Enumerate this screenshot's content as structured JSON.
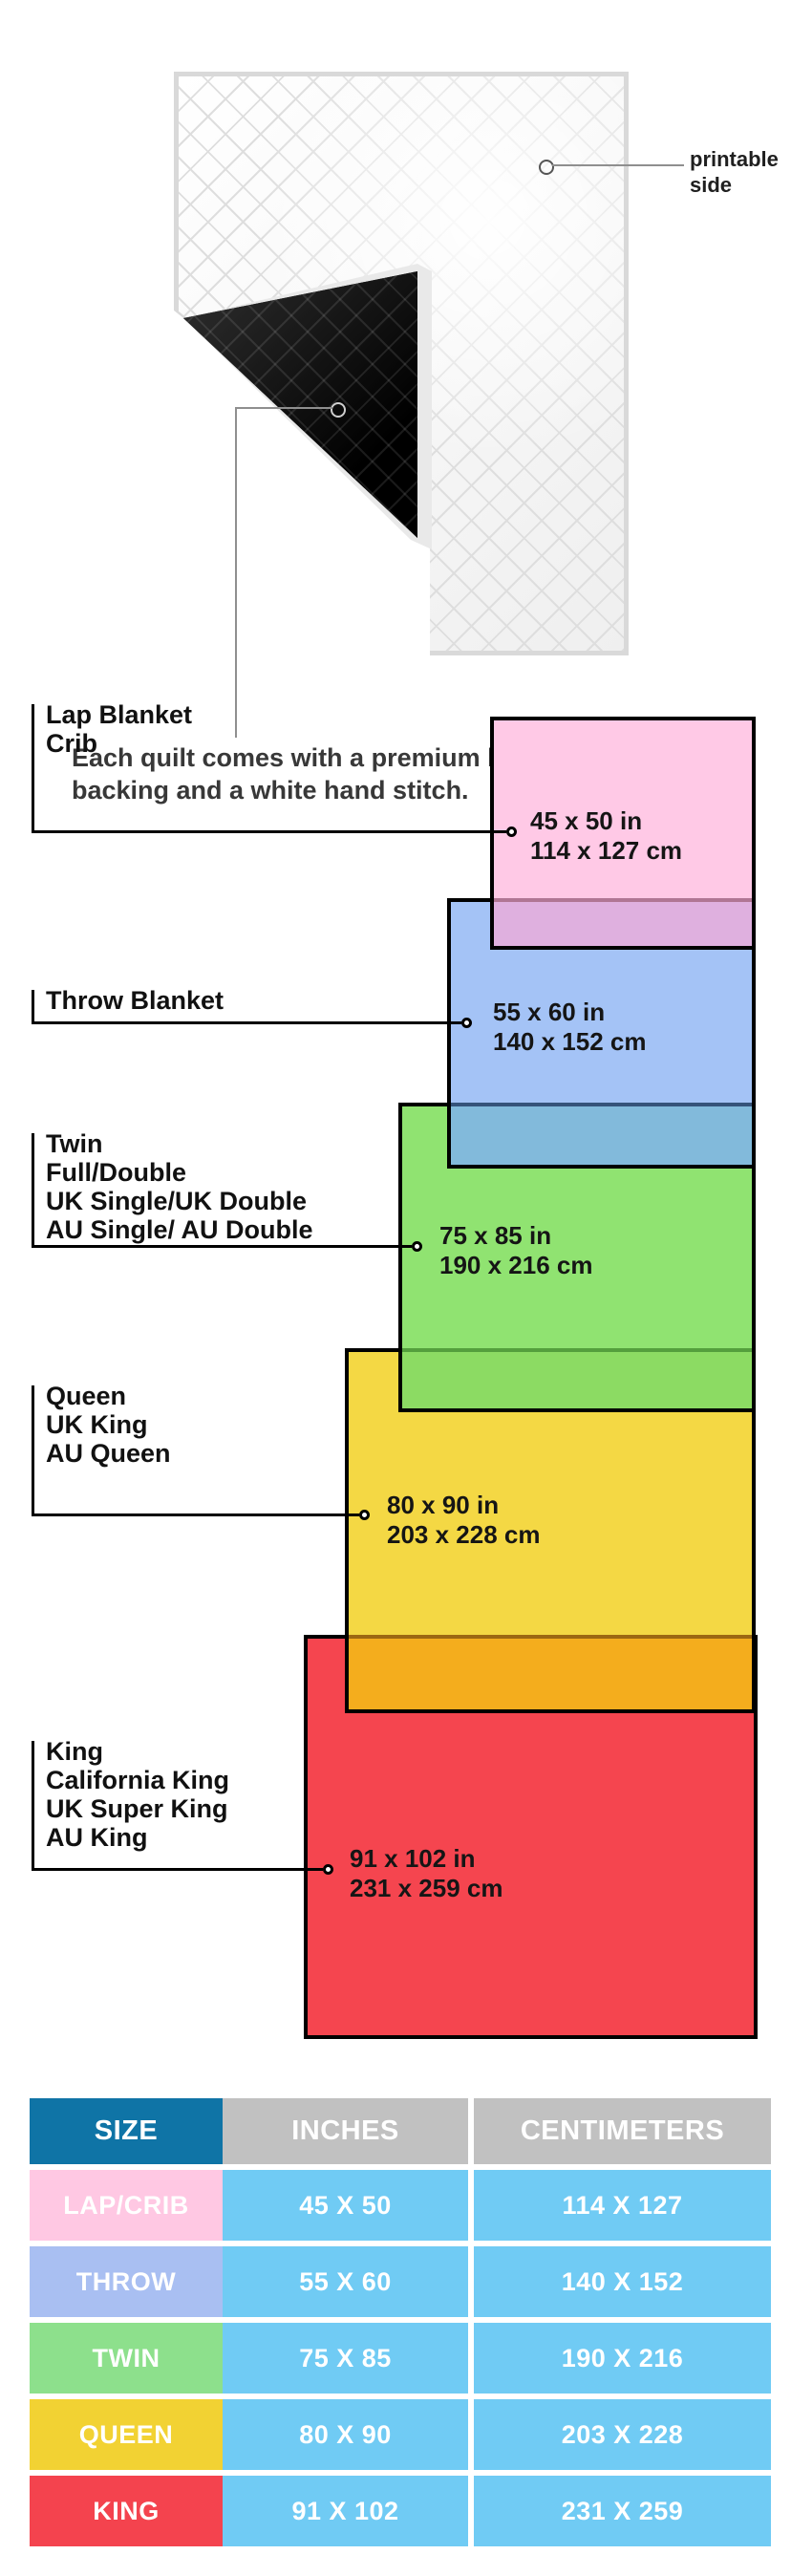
{
  "quilt": {
    "printable_line1": "printable",
    "printable_line2": "side",
    "note_line1": "Each quilt comes with a premium black polyester",
    "note_line2": "backing and a white hand stitch."
  },
  "diagram": {
    "items": [
      {
        "id": "lap",
        "label_lines": [
          "Lap Blanket",
          "Crib",
          "",
          ""
        ],
        "dim_in": "45 x 50 in",
        "dim_cm": "114 x 127 cm",
        "fill": "#FFC9E6",
        "overlap_fill": "#DFB0DF"
      },
      {
        "id": "throw",
        "label_lines": [
          "Throw Blanket",
          "",
          "",
          ""
        ],
        "dim_in": "55 x 60 in",
        "dim_cm": "140 x 152 cm",
        "fill": "#A4C3F6",
        "overlap_fill": "#82BADB"
      },
      {
        "id": "twin",
        "label_lines": [
          "Twin",
          "Full/Double",
          "UK Single/UK Double",
          "AU Single/ AU Double"
        ],
        "dim_in": "75 x 85 in",
        "dim_cm": "190 x 216 cm",
        "fill": "#90E371",
        "overlap_fill": "#8CDB63"
      },
      {
        "id": "queen",
        "label_lines": [
          "Queen",
          "UK King",
          "AU Queen",
          ""
        ],
        "dim_in": "80 x 90 in",
        "dim_cm": "203 x 228 cm",
        "fill": "#F4D844",
        "overlap_fill": "#F4AD1D"
      },
      {
        "id": "king",
        "label_lines": [
          "King",
          "California King",
          "UK Super King",
          "AU King"
        ],
        "dim_in": "91 x 102 in",
        "dim_cm": "231 x 259 cm",
        "fill": "#F5454F",
        "overlap_fill": ""
      }
    ]
  },
  "table": {
    "headers": [
      "SIZE",
      "INCHES",
      "CENTIMETERS"
    ],
    "header_bg": "#0F74A6",
    "header_alt_bg": "#C1C1C1",
    "value_bg": "#70CBF4",
    "rows": [
      {
        "size": "LAP/CRIB",
        "inches": "45 X 50",
        "cm": "114 X 127",
        "bg": "#FFC8E3"
      },
      {
        "size": "THROW",
        "inches": "55 X 60",
        "cm": "140 X 152",
        "bg": "#A9BFF2"
      },
      {
        "size": "TWIN",
        "inches": "75 X 85",
        "cm": "190 X 216",
        "bg": "#8DE08C"
      },
      {
        "size": "QUEEN",
        "inches": "80 X 90",
        "cm": "203 X 228",
        "bg": "#F2D233"
      },
      {
        "size": "KING",
        "inches": "91 X 102",
        "cm": "231 X 259",
        "bg": "#F4434E"
      }
    ]
  }
}
